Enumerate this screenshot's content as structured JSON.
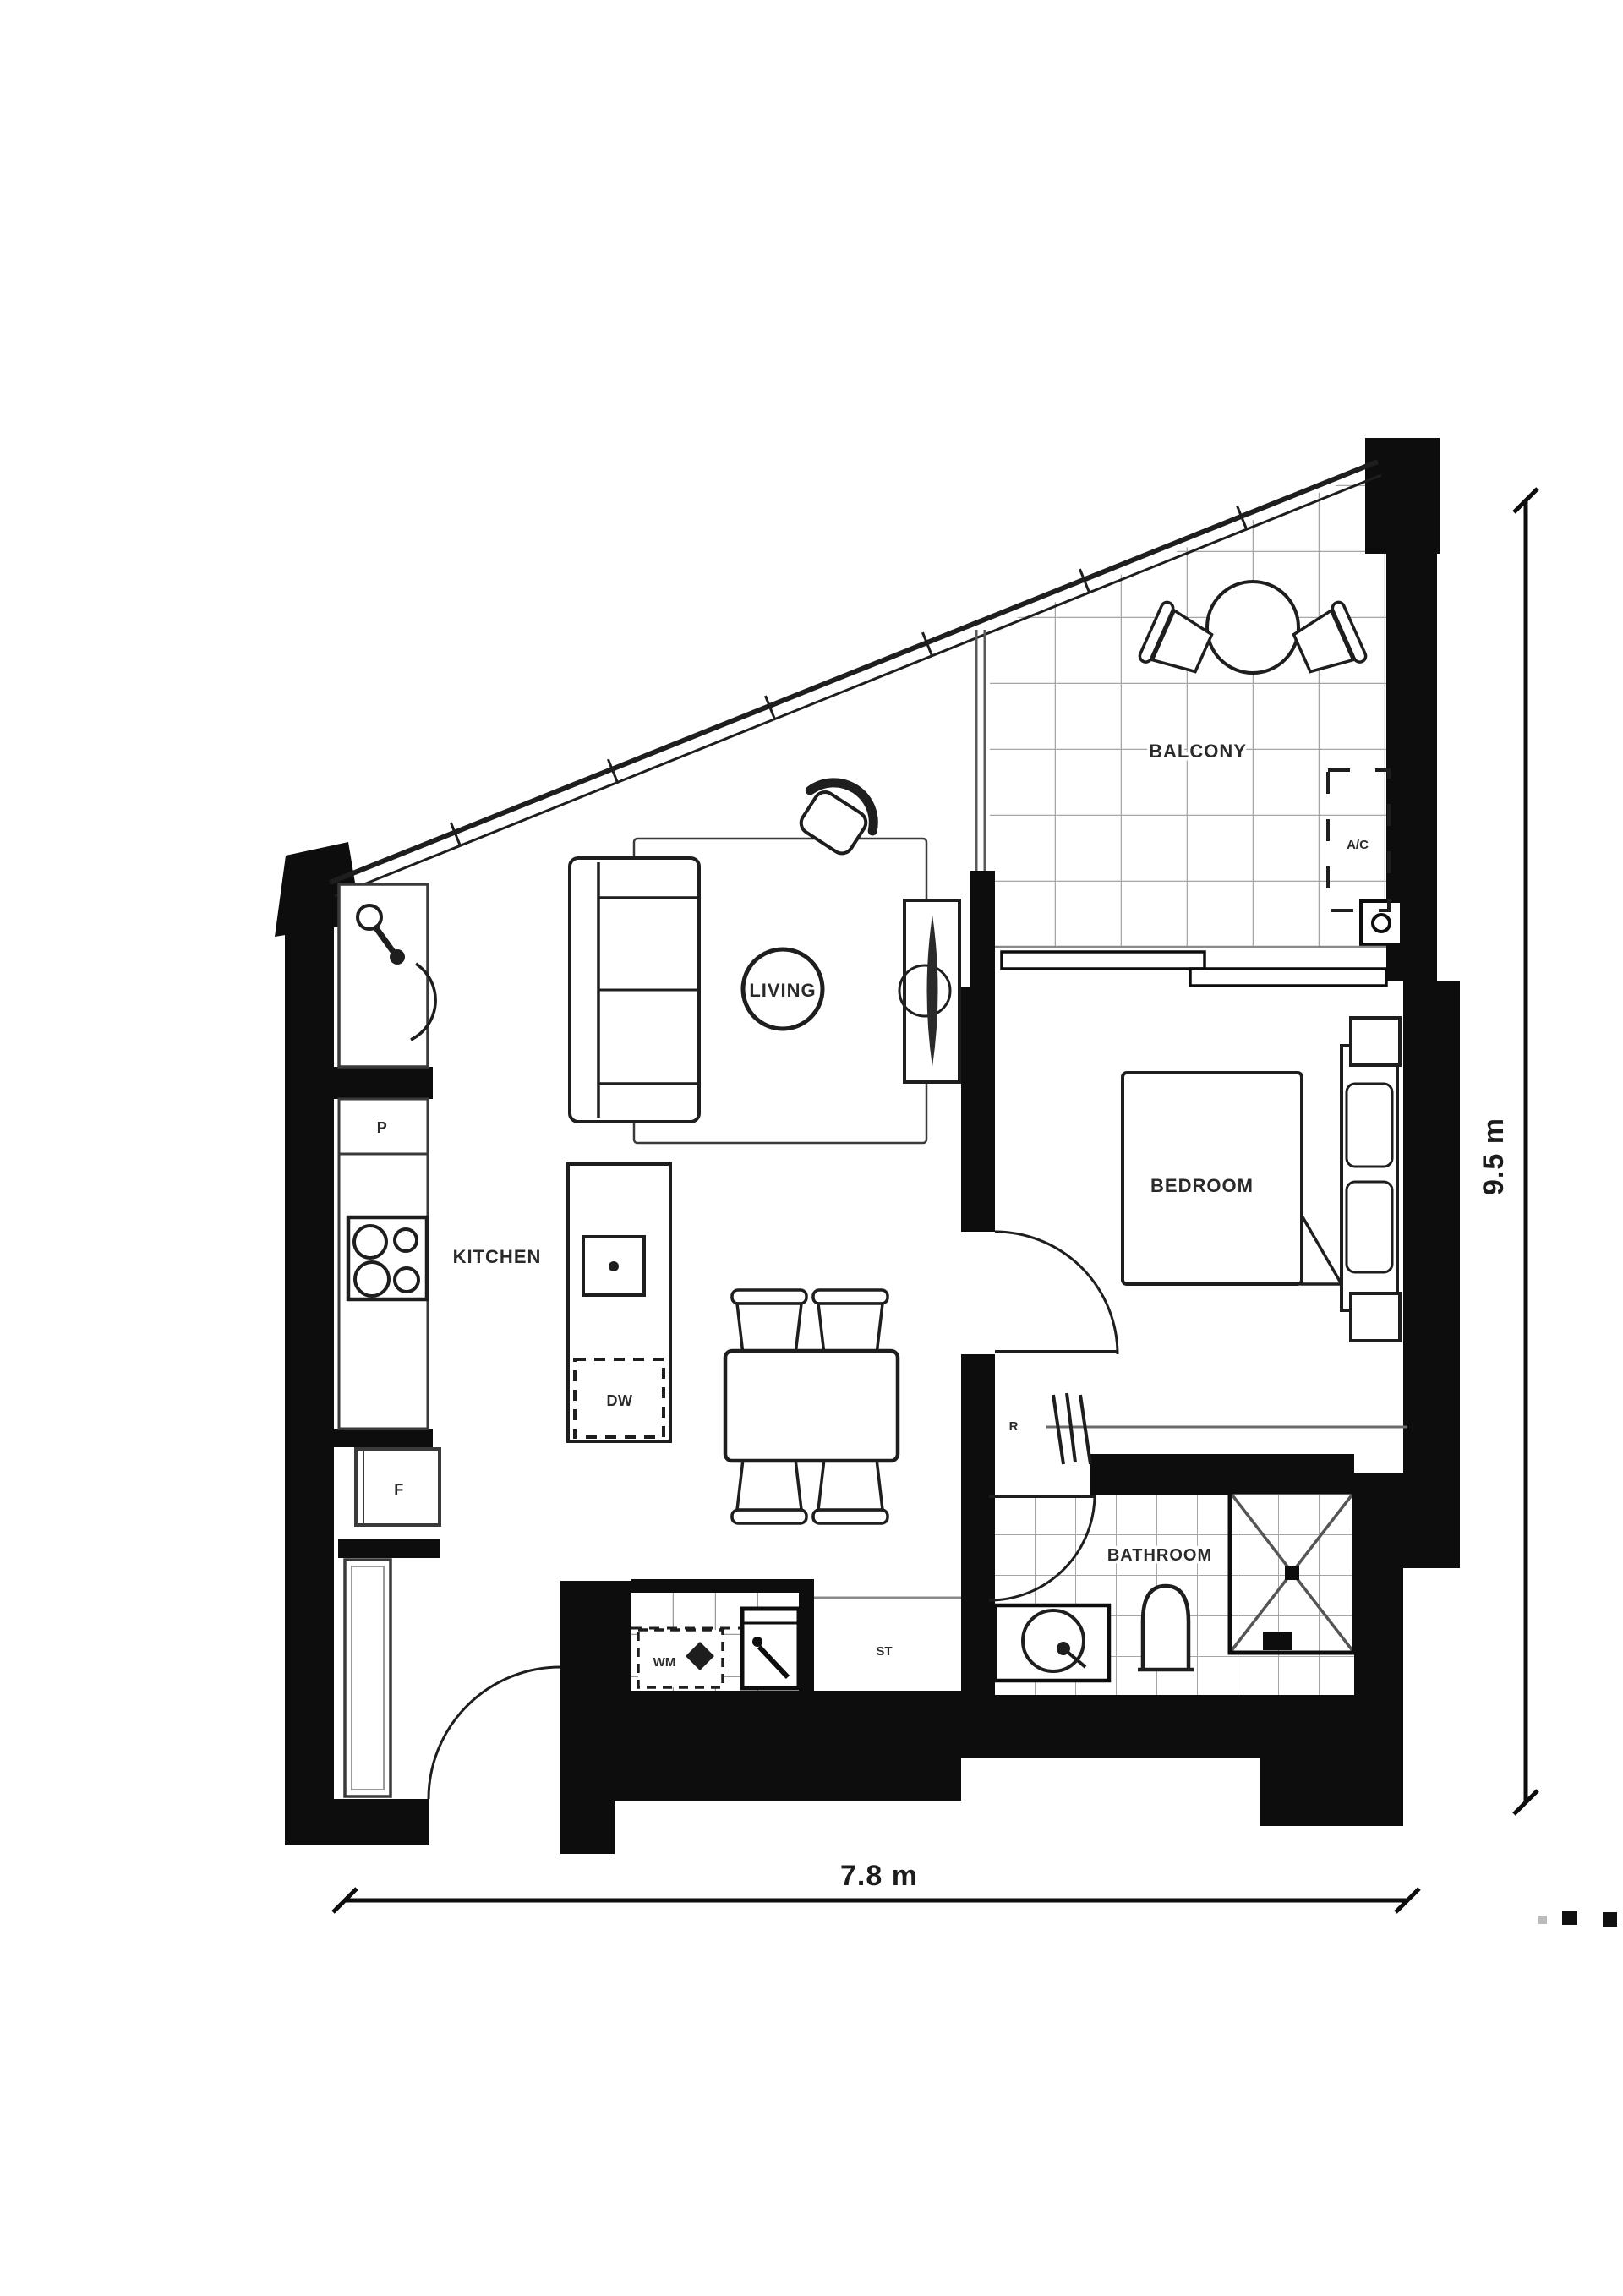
{
  "page": {
    "type": "apartment floor plan drawing",
    "background": "#ffffff"
  },
  "plan": {
    "rooms": {
      "living": "LIVING",
      "bedroom": "BEDROOM",
      "kitchen": "KITCHEN",
      "bathroom": "BATHROOM",
      "balcony": "BALCONY"
    },
    "fixtures": {
      "pantry": "P",
      "fridge": "F",
      "dishwasher": "DW",
      "washing_machine": "WM",
      "storage": "ST",
      "robe": "R",
      "air_conditioner": "A/C"
    },
    "dimensions": {
      "width": "7.8 m",
      "depth": "9.5 m"
    },
    "colors": {
      "wall": "#0d0d0d",
      "furniture_line": "#1e1e1e",
      "tile_line": "#a6a6a6",
      "window_line": "#5a5a5a",
      "label_text": "#2a2a2a"
    },
    "icons": {
      "sofa-icon": "three-seat sofa, top view",
      "armchair-icon": "occasional chair, top view",
      "tv-unit-icon": "tv cabinet with television",
      "rug-icon": "rectangular rug outline",
      "dining-table-icon": "4-seat dining table",
      "bed-icon": "queen bed with headboard and pillows",
      "nightstand-icon": "bedside table",
      "balcony-table-icon": "round outdoor table",
      "balcony-chair-icon": "outdoor chair",
      "kitchen-sink-icon": "kitchen sink with swivel tap",
      "cooktop-icon": "4-burner cooktop",
      "island-sink-icon": "island prep sink",
      "toilet-icon": "toilet, top view",
      "vanity-basin-icon": "vanity with round basin",
      "shower-icon": "tiled shower with cross marking",
      "washing-machine-icon": "washing machine (dashed)",
      "laundry-tub-icon": "laundry tub",
      "wardrobe-rail-icon": "robe hanging rail",
      "door-swing-icon": "door swing arc",
      "drain-icon": "balcony drain point",
      "page-dots-icon": "trailing page dots"
    }
  }
}
